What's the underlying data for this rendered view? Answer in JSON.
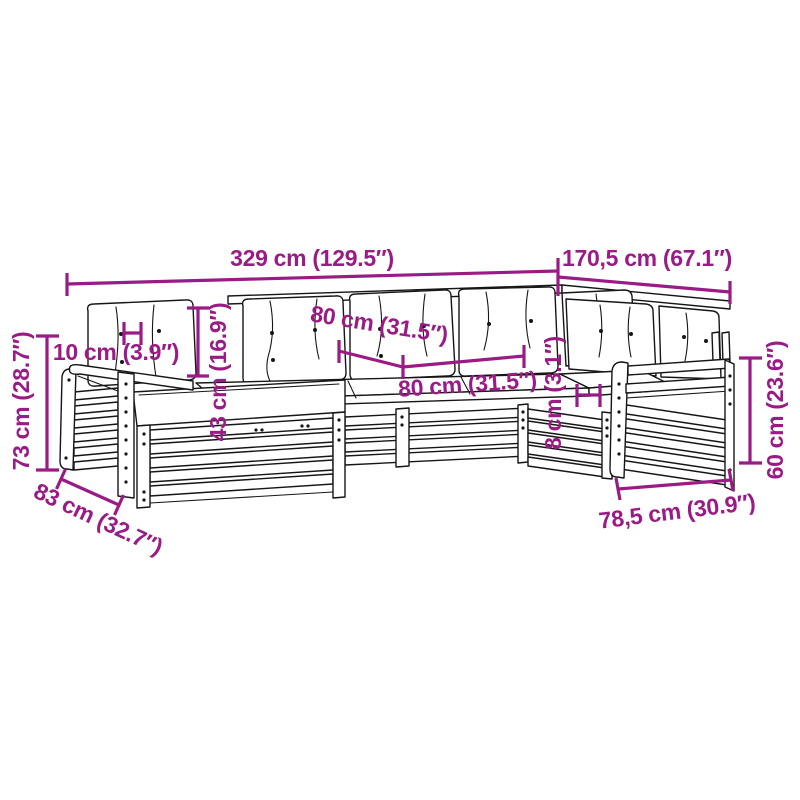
{
  "page": {
    "background_color": "#ffffff"
  },
  "diagram": {
    "accent_color": "#9b1b86",
    "line_color": "#161616",
    "labels": {
      "overall_width": "329 cm (129.5″)",
      "overall_depth": "170,5 cm (67.1″)",
      "left_height": "73 cm (28.7″)",
      "armrest_width": "10 cm (3.9″)",
      "backrest_height": "43 cm (16.9″)",
      "module_width_back": "80 cm (31.5″)",
      "module_width_front": "80 cm (31.5″)",
      "frame_gap": "8 cm (3.1″)",
      "right_height": "60 cm (23.6″)",
      "left_depth": "83 cm (32.7″)",
      "right_depth": "78,5 cm (30.9″)"
    }
  }
}
